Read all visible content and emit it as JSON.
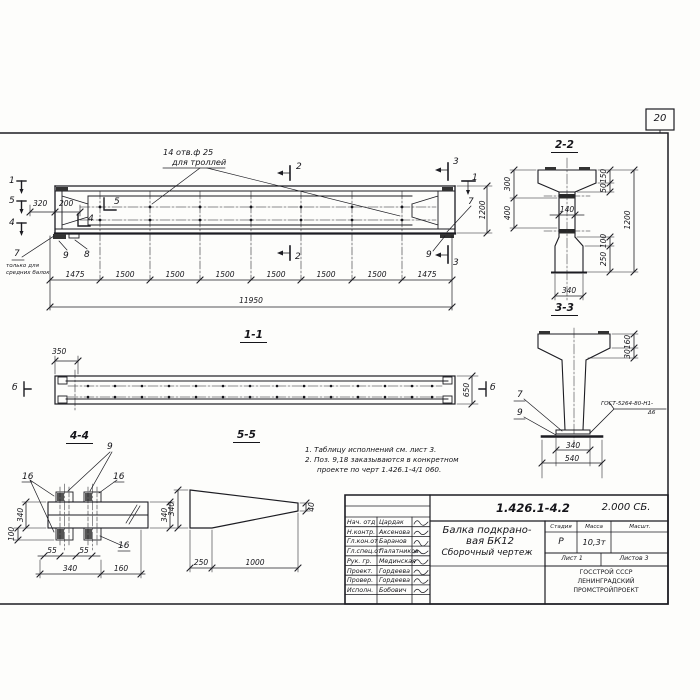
{
  "sheet": {
    "page_number": "20"
  },
  "elevation": {
    "hole_note1": "14 отв.ф 25",
    "hole_note2": "для троллей",
    "cut1": "1",
    "cut5": "5",
    "cut4": "4",
    "cut5_inner": "5",
    "cut4_inner": "4",
    "cut2_top": "2",
    "cut2_bot": "2",
    "cut3_top": "3",
    "cut3_bot": "3",
    "cut1_right": "1",
    "dim320": "320",
    "dim200": "200",
    "dim1200": "1200",
    "pos7_left": "7",
    "pos9_left": "9",
    "pos8": "8",
    "pos7_right": "7",
    "pos9_right": "9",
    "note7_line1": "только для",
    "note7_line2": "средних балок",
    "seg": [
      "1475",
      "1500",
      "1500",
      "1500",
      "1500",
      "1500",
      "1500",
      "1475"
    ],
    "total": "11950"
  },
  "sec11": {
    "title": "1-1",
    "dim350": "350",
    "dim650": "650",
    "mark_left": "б",
    "mark_right": "б"
  },
  "sec22": {
    "title": "2-2",
    "d300": "300",
    "d400": "400",
    "d150": "150",
    "d50": "50",
    "d140": "140",
    "d1200": "1200",
    "d100": "100",
    "d250": "250",
    "d340": "340"
  },
  "sec33": {
    "title": "3-3",
    "d160": "160",
    "d30": "30",
    "p7": "7",
    "p9": "9",
    "weld1": "ГОСТ-5264-80-Н1-",
    "weld2": "Δ6",
    "d340": "340",
    "d540": "540"
  },
  "sec44": {
    "title": "4-4",
    "p9": "9",
    "p16a": "16",
    "p16b": "16",
    "p16c": "16",
    "d340_left": "340",
    "d100": "100",
    "d340_right": "340",
    "d55a": "55",
    "d55b": "55",
    "d340_bottom": "340",
    "d160": "160"
  },
  "sec55": {
    "title": "5-5",
    "d340": "340",
    "d40": "40",
    "d250": "250",
    "d1000": "1000"
  },
  "notes": {
    "l1": "1. Таблицу исполнений см. лист 3.",
    "l2": "2. Поз. 9,18 заказываются в конкретном",
    "l3": "проекте по черт 1.426.1-4/1 060."
  },
  "stamp": {
    "doc": "1.426.1-4.2",
    "series": "2.000 СБ.",
    "title1": "Балка подкрано-",
    "title2": "вая БК12",
    "title3": "Сборочный чертеж",
    "h_stage": "Стадия",
    "h_mass": "Масса",
    "h_scale": "Масшт.",
    "stage": "Р",
    "mass": "10,3т",
    "sheet": "Лист 1",
    "sheets": "Листов 3",
    "org1": "ГОССТРОЙ СССР",
    "org2": "ЛЕНИНГРАДСКИЙ",
    "org3": "ПРОМСТРОЙПРОЕКТ",
    "rows": [
      {
        "role": "Нач. отд",
        "name": "Цардак"
      },
      {
        "role": "Н.контр.",
        "name": "Аксенова"
      },
      {
        "role": "Гл.кон.от",
        "name": "Баранов"
      },
      {
        "role": "Гл.спец.от",
        "name": "Палатников"
      },
      {
        "role": "Рук. гр.",
        "name": "Мединская"
      },
      {
        "role": "Проект.",
        "name": "Гордеева"
      },
      {
        "role": "Провер.",
        "name": "Гордеева"
      },
      {
        "role": "Исполн.",
        "name": "Бобович"
      }
    ]
  }
}
